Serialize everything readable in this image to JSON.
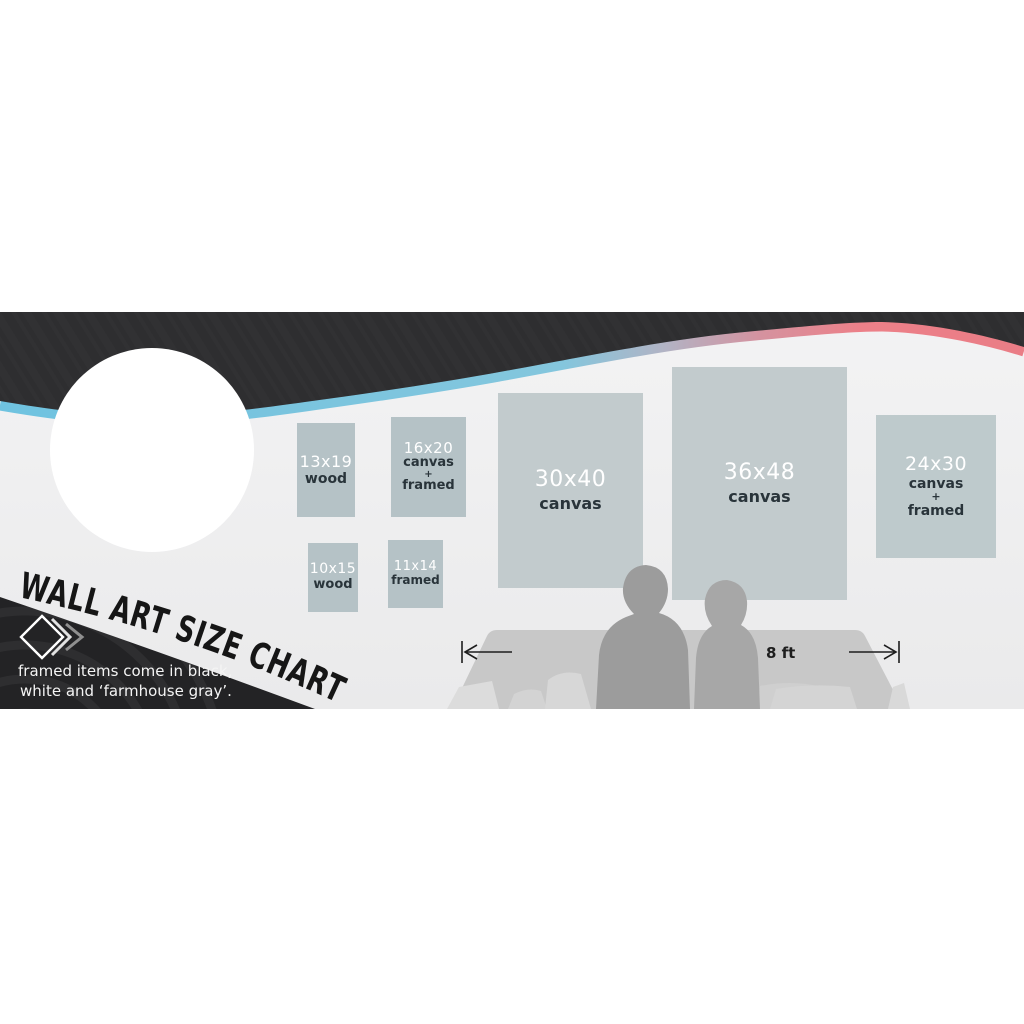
{
  "banner": {
    "title": "WALL ART SIZE CHART",
    "tagline": {
      "line1": "framed items come in black,",
      "line2": "white and ‘farmhouse gray’."
    },
    "measurement_label": "8 ft",
    "art_sizes": [
      {
        "label": "13x19",
        "materials": [
          "wood"
        ]
      },
      {
        "label": "16x20",
        "materials": [
          "canvas",
          "+",
          "framed"
        ]
      },
      {
        "label": "30x40",
        "materials": [
          "canvas"
        ]
      },
      {
        "label": "36x48",
        "materials": [
          "canvas"
        ]
      },
      {
        "label": "24x30",
        "materials": [
          "canvas",
          "+",
          "framed"
        ]
      },
      {
        "label": "10x15",
        "materials": [
          "wood"
        ]
      },
      {
        "label": "11x14",
        "materials": [
          "framed"
        ]
      }
    ],
    "icons": [
      "diamond-logo-icon",
      "chevron-right-icon",
      "measure-arrow-left-icon",
      "measure-arrow-right-icon"
    ],
    "colors": {
      "dark_band": "#2e2e30",
      "bottom_swoosh": "#232325",
      "accent_edge_cyan": "#6fc3e0",
      "accent_edge_pink": "#ec8089",
      "light_background": "#f1f1f2",
      "box_small_fill": "#b5c2c6",
      "box_large_fill": "#c2cbcd",
      "size_text": "#ffffff",
      "material_text": "#29343a",
      "couch_gray": "#c8c8c8",
      "silhouette_gray": "#9c9c9c"
    }
  }
}
